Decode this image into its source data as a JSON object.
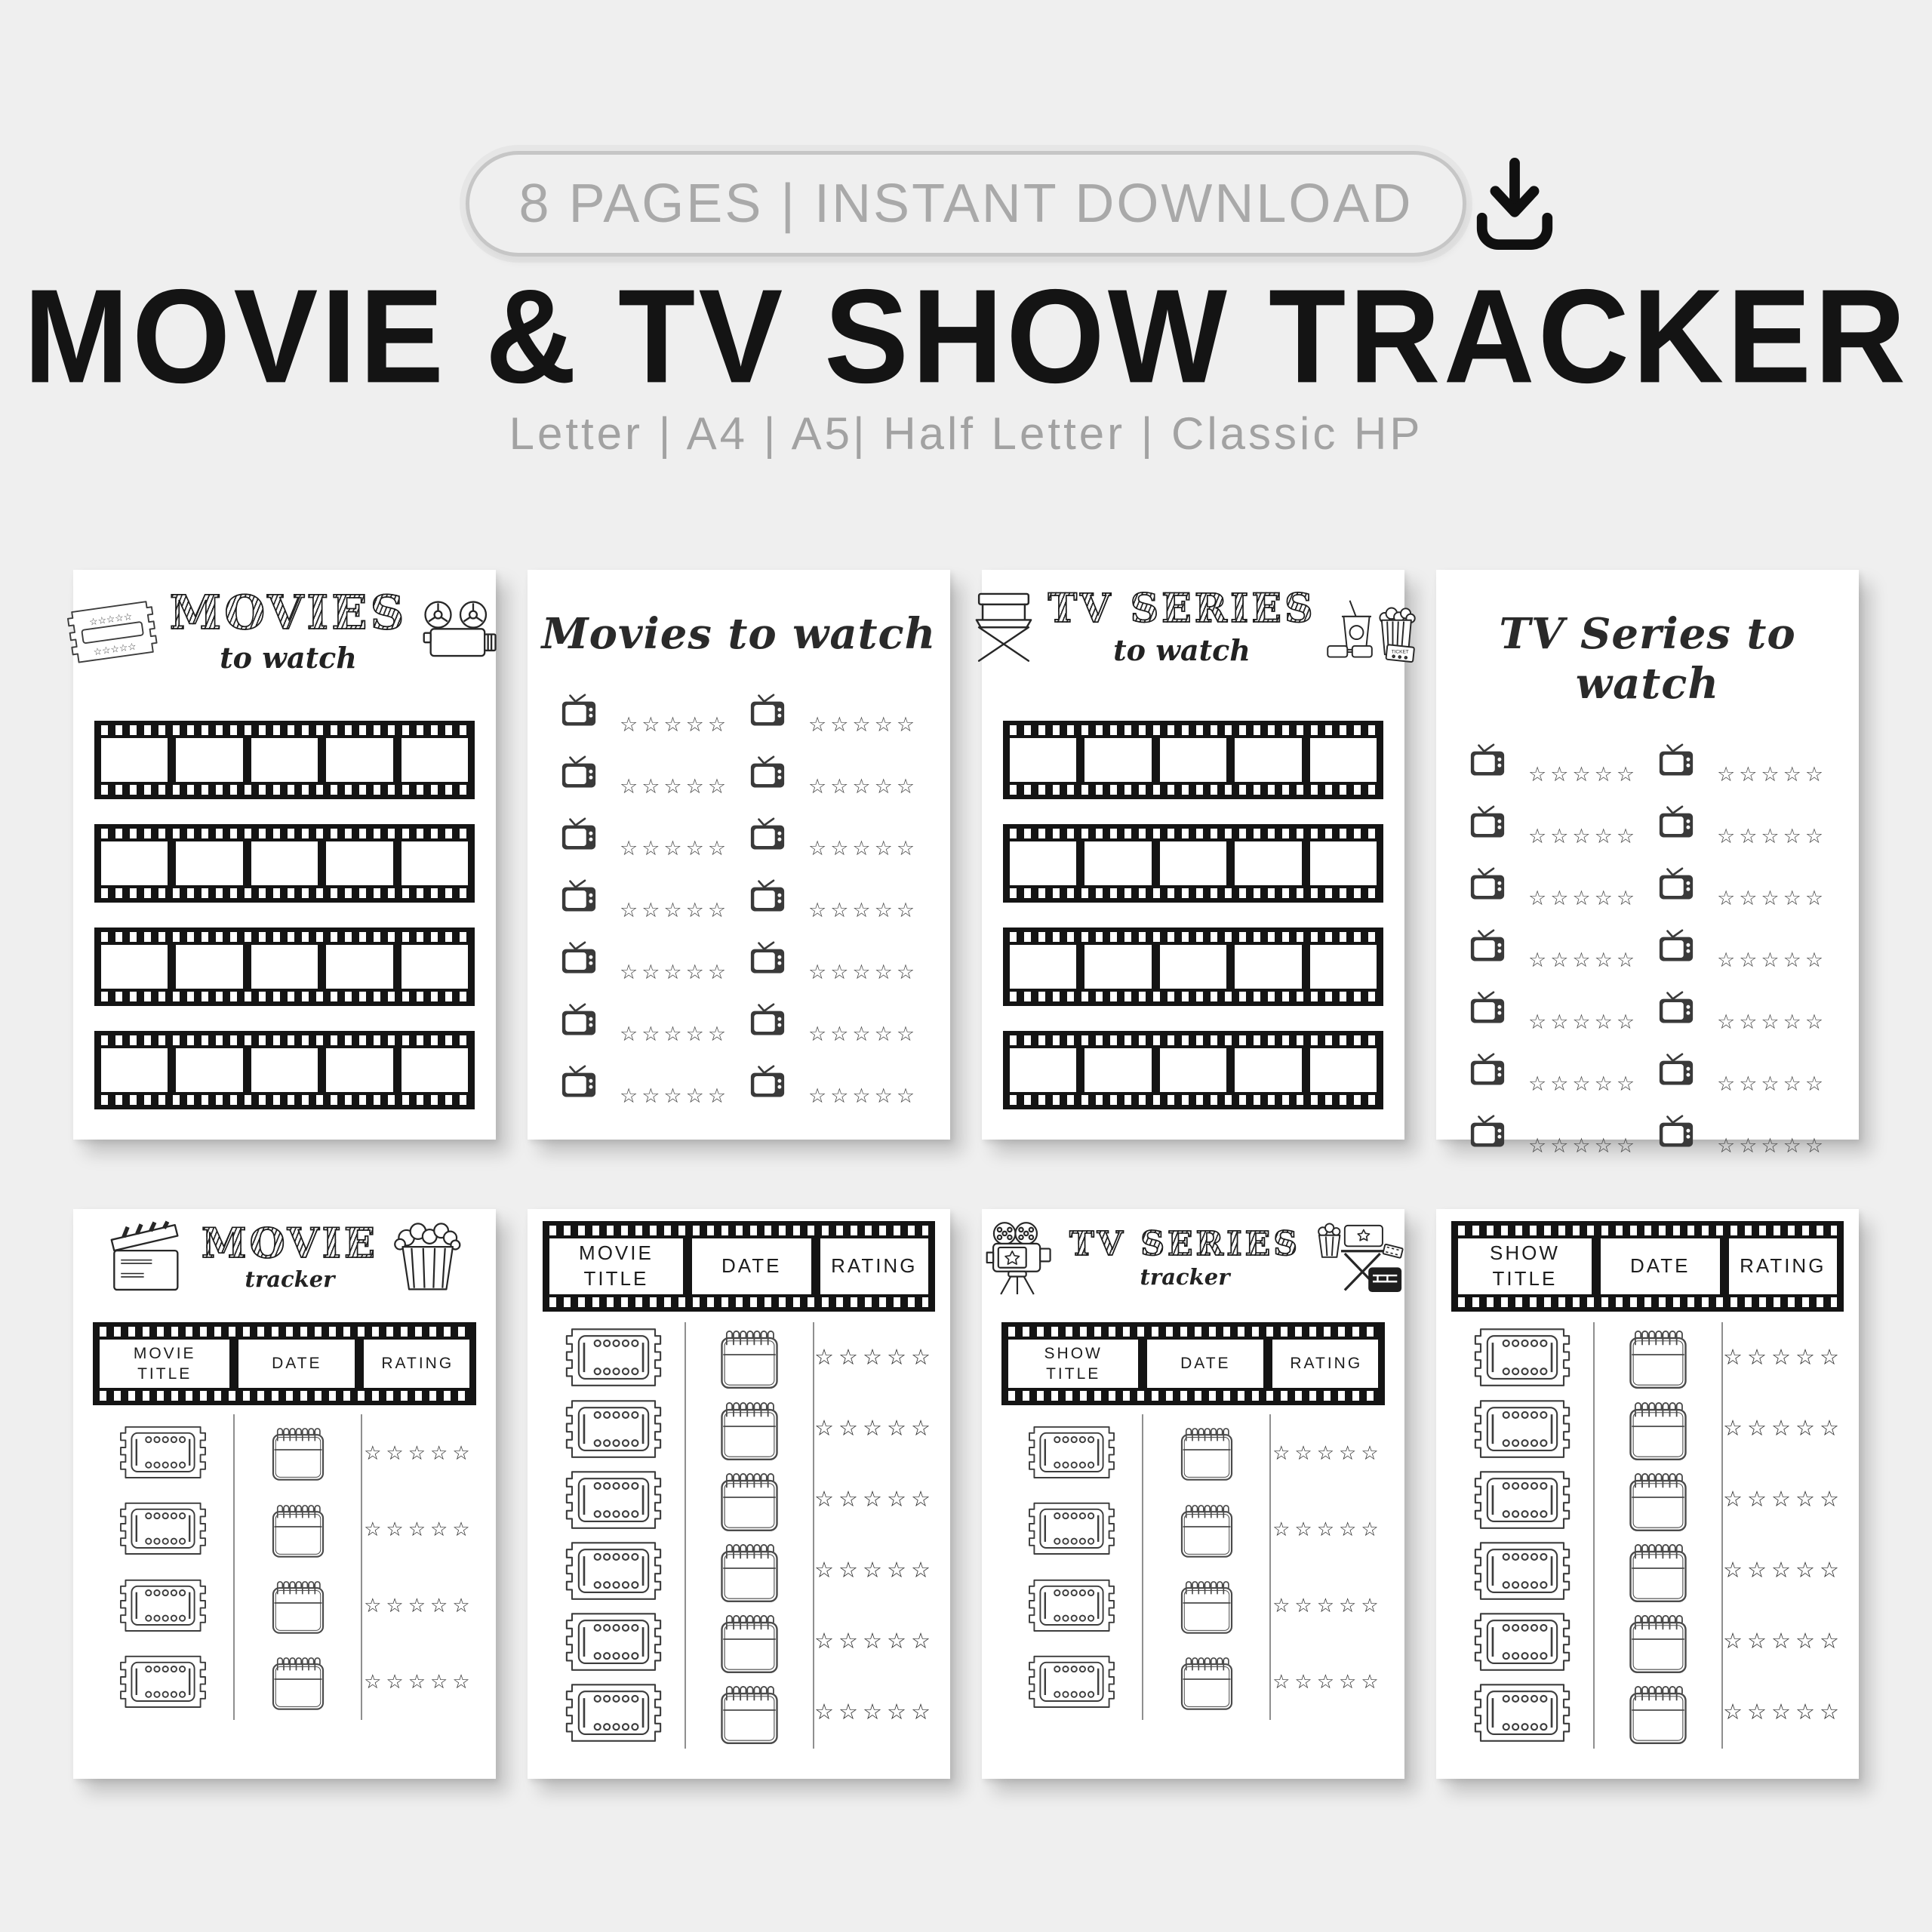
{
  "header": {
    "badge_label": "8 PAGES | INSTANT DOWNLOAD",
    "title": "MOVIE & TV SHOW TRACKER",
    "subtitle": "Letter | A4 | A5| Half Letter | Classic HP"
  },
  "rating_stars": "☆☆☆☆☆",
  "icon_labels": {
    "ticket": "TICKET"
  },
  "icons": {
    "download": "download-icon",
    "ticket": "ticket-icon",
    "projector": "movie-projector-icon",
    "tv": "tv-icon",
    "director_chair": "director-chair-icon",
    "snacks": "snacks-icon",
    "clapperboard": "clapperboard-icon",
    "popcorn": "popcorn-icon",
    "film_camera": "film-camera-icon",
    "cinema_props": "cinema-props-icon",
    "calendar": "calendar-icon"
  },
  "colors": {
    "background": "#efefef",
    "page": "#ffffff",
    "ink": "#141414",
    "muted_gray": "#a2a2a2",
    "filmstrip_black": "#141414"
  },
  "pages": {
    "p1": {
      "title": "MOVIES",
      "script": "to watch",
      "strips": 4,
      "frames_per_strip": 5
    },
    "p2": {
      "title": "Movies to watch",
      "entries": 14,
      "stars_per_entry": 5
    },
    "p3": {
      "title": "TV SERIES",
      "script": "to watch",
      "strips": 4,
      "frames_per_strip": 5
    },
    "p4": {
      "title": "TV Series to watch",
      "entries": 14,
      "stars_per_entry": 5
    },
    "p5": {
      "title": "MOVIE",
      "script": "tracker",
      "columns": [
        "MOVIE TITLE",
        "DATE",
        "RATING"
      ],
      "rows": 4
    },
    "p6": {
      "columns": [
        "MOVIE TITLE",
        "DATE",
        "RATING"
      ],
      "rows": 6
    },
    "p7": {
      "title": "TV SERIES",
      "script": "tracker",
      "columns": [
        "SHOW TITLE",
        "DATE",
        "RATING"
      ],
      "rows": 4
    },
    "p8": {
      "columns": [
        "SHOW TITLE",
        "DATE",
        "RATING"
      ],
      "rows": 6
    }
  }
}
